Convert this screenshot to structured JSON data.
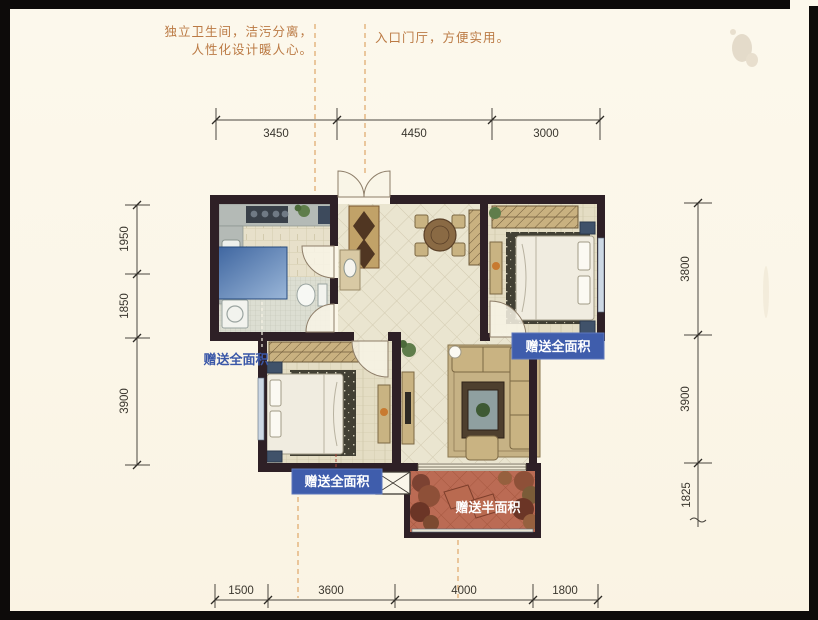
{
  "annotations": {
    "bathroom_line1": "独立卫生间，洁污分离，",
    "bathroom_line2": "人性化设计暖人心。",
    "entry": "入口门厅，方便实用。"
  },
  "gift_labels": {
    "left": "赠送全面积",
    "right": "赠送全面积",
    "bottom": "赠送全面积",
    "balcony": "赠送半面积"
  },
  "dimensions": {
    "top": [
      "3450",
      "4450",
      "3000"
    ],
    "left": [
      "1950",
      "1850",
      "3900"
    ],
    "right": [
      "3800",
      "3900",
      "1825"
    ],
    "bottom": [
      "1500",
      "3600",
      "4000",
      "1800"
    ]
  },
  "colors": {
    "paper": "#fbf6e8",
    "wall": "#2e2026",
    "label_blue": "#3f5dac",
    "annotation_orange": "#bb7a44",
    "guide_dash_orange": "#dfa768",
    "balcony_terracotta": "#b96852",
    "bay_window_blue": "#466ea6"
  }
}
